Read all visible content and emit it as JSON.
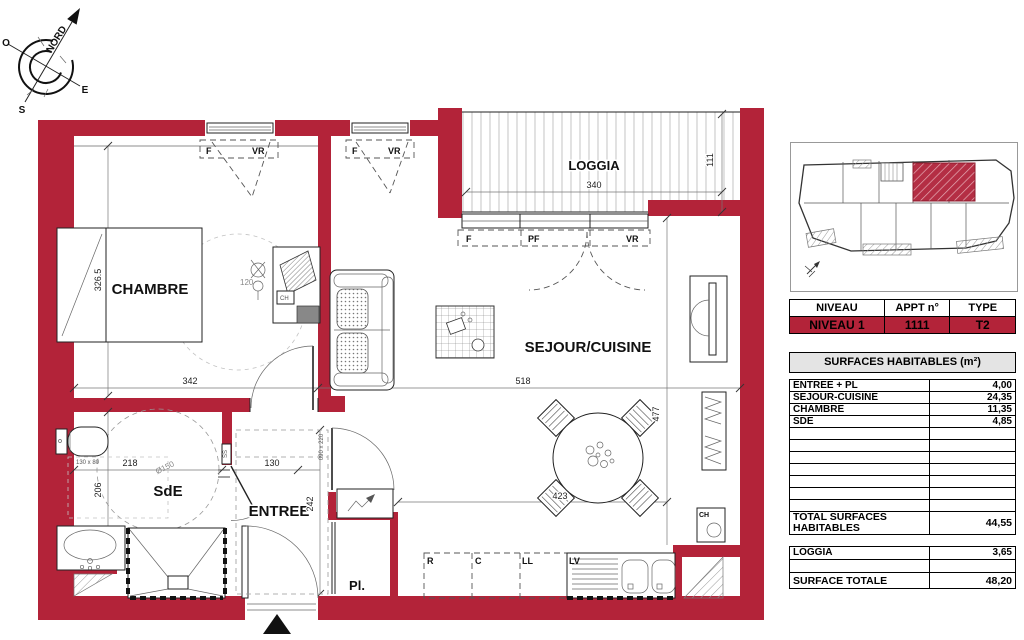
{
  "compass": {
    "north": "NORD",
    "west": "O",
    "east": "E",
    "south": "S"
  },
  "plan": {
    "room_labels": {
      "chambre": "CHAMBRE",
      "sde": "SdE",
      "entree": "ENTREE",
      "sejour": "SEJOUR/CUISINE",
      "loggia": "LOGGIA",
      "placard": "Pl."
    },
    "dims": {
      "chambre_h": "326.5",
      "chambre_w": "342",
      "sejour_w": "518",
      "sejour_h": "477",
      "dining_w": "423",
      "loggia_w": "340",
      "loggia_d": "111",
      "sde_w": "218",
      "sde_h": "206",
      "sde_turn": "Ø150",
      "wc_zone": "130 x 80",
      "entree_w": "130",
      "entree_h": "242",
      "door_size": "090 x 220",
      "desk_note": "120"
    },
    "window_labels": {
      "f": "F",
      "pf": "PF",
      "vr": "VR"
    },
    "equip_labels": {
      "fridge": "R",
      "cooker": "C",
      "washer": "LL",
      "dishwasher": "LV",
      "water_heater": "CH",
      "towel_rail": "SS",
      "desk_unit": "CH"
    }
  },
  "panel": {
    "info": {
      "headers": [
        "NIVEAU",
        "APPT n°",
        "TYPE"
      ],
      "values": [
        "NIVEAU 1",
        "1111",
        "T2"
      ]
    },
    "surfaces": {
      "title": "SURFACES HABITABLES (m²)",
      "rows": [
        {
          "label": "ENTREE + PL",
          "value": "4,00"
        },
        {
          "label": "SEJOUR-CUISINE",
          "value": "24,35"
        },
        {
          "label": "CHAMBRE",
          "value": "11,35"
        },
        {
          "label": "SDE",
          "value": "4,85"
        }
      ],
      "total": {
        "label": "TOTAL SURFACES HABITABLES",
        "value": "44,55"
      },
      "loggia": {
        "label": "LOGGIA",
        "value": "3,65"
      },
      "grand_total": {
        "label": "SURFACE TOTALE",
        "value": "48,20"
      }
    }
  },
  "colors": {
    "wall_red": "#b32339",
    "hatch_gray": "#9a9a9a",
    "table_gray": "#e4e4e4"
  }
}
